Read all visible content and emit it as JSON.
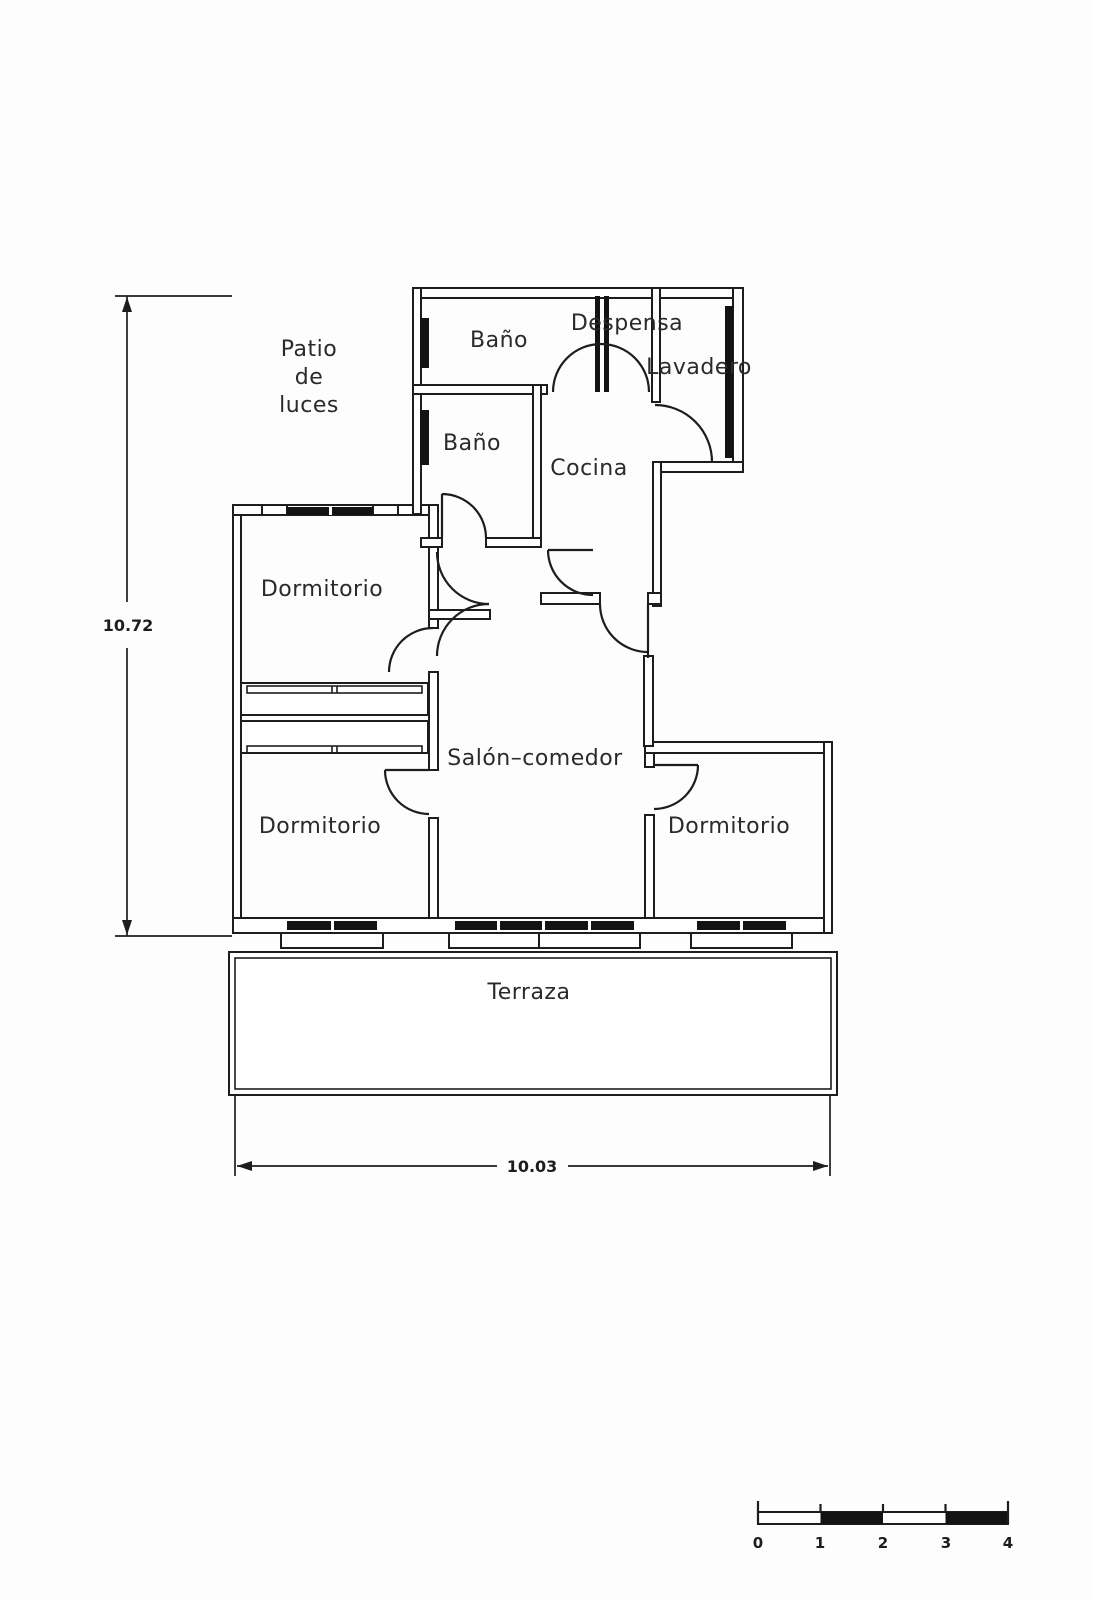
{
  "meta": {
    "paper_color": "#fdfdfd",
    "ink_color": "#1d1d1d",
    "drawing_type": "apartment floor plan"
  },
  "plan": {
    "rooms": {
      "bano_top": "Baño",
      "despensa": "Despensa",
      "lavadero": "Lavadero",
      "bano_mid": "Baño",
      "cocina": "Cocina",
      "dormitorio_tl": "Dormitorio",
      "salon": "Salón–comedor",
      "dormitorio_bl": "Dormitorio",
      "dormitorio_br": "Dormitorio",
      "terraza": "Terraza"
    },
    "patio": {
      "line1": "Patio",
      "line2": "de",
      "line3": "luces"
    },
    "dimensions": {
      "height": "10.72",
      "width": "10.03"
    },
    "scale_bar": {
      "ticks": [
        "0",
        "1",
        "2",
        "3",
        "4"
      ]
    }
  }
}
